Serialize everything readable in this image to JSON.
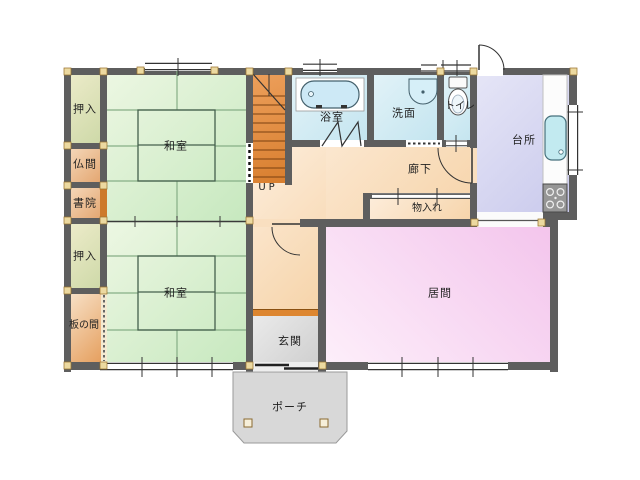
{
  "title": "house-floor-plan",
  "rooms": {
    "oshiire_top": {
      "label": "押入"
    },
    "butsuma": {
      "label": "仏間"
    },
    "shoin": {
      "label": "書院"
    },
    "oshiire_bottom": {
      "label": "押入"
    },
    "itanoma": {
      "label": "板の間"
    },
    "washitsu_top": {
      "label": "和室"
    },
    "washitsu_bottom": {
      "label": "和室"
    },
    "bathroom": {
      "label": "浴室"
    },
    "washroom": {
      "label": "洗面"
    },
    "toilet": {
      "label": "トイレ"
    },
    "kitchen": {
      "label": "台所"
    },
    "corridor": {
      "label": "廊下"
    },
    "storage": {
      "label": "物入れ"
    },
    "living": {
      "label": "居間"
    },
    "genkan": {
      "label": "玄関"
    },
    "porch": {
      "label": "ポーチ"
    }
  },
  "stairs": {
    "label": "UP"
  },
  "colors": {
    "wall": "#5e5e5e",
    "tatami_room": "#d8efd0",
    "closet": "#dde2b6",
    "altar_room": "#ecc195",
    "wood_floor": "#efbf91",
    "wet_area": "#d2ebf4",
    "kitchen": "#d8d8f2",
    "corridor": "#f9e0c2",
    "living_room": "#f8daf4",
    "entrance": "#dcdcdc",
    "porch": "#d8d8d8",
    "stairs": "#e28f45",
    "threshold_accent": "#dd8630",
    "post": "#ecd9a0"
  }
}
